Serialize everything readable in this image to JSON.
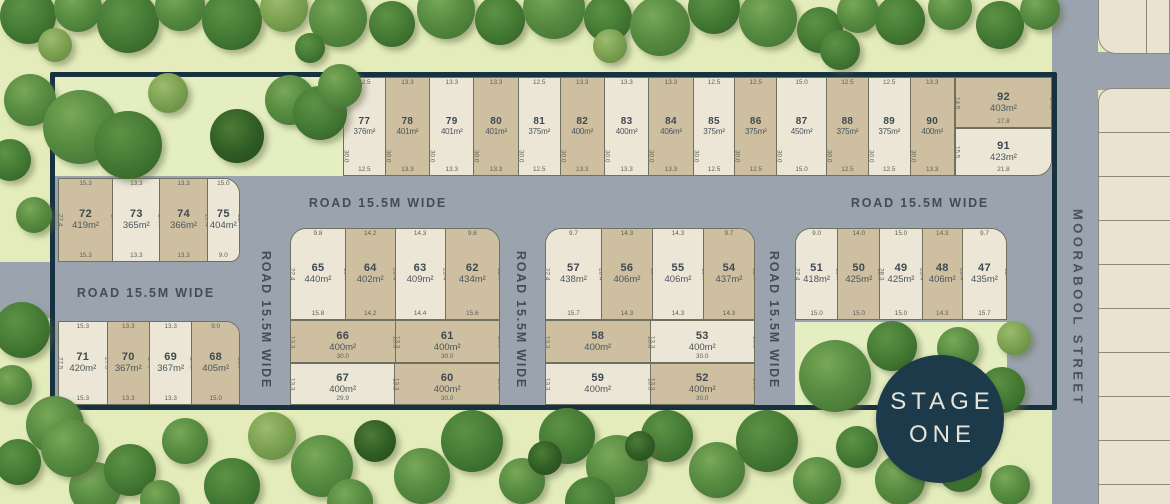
{
  "road_label": "ROAD 15.5M WIDE",
  "street_name": "MOORABOOL STREET",
  "stage_badge": {
    "line1": "STAGE",
    "line2": "ONE"
  },
  "clusters": {
    "top_row": [
      {
        "num": "77",
        "area": "376m²",
        "shade": "cream",
        "dims": {
          "top": "12.5",
          "bottom": "12.5",
          "side": "30.0"
        }
      },
      {
        "num": "78",
        "area": "401m²",
        "shade": "tan",
        "dims": {
          "top": "13.3",
          "bottom": "13.3",
          "side": "30.0"
        }
      },
      {
        "num": "79",
        "area": "401m²",
        "shade": "cream",
        "dims": {
          "top": "13.3",
          "bottom": "13.3",
          "side": "30.0"
        }
      },
      {
        "num": "80",
        "area": "401m²",
        "shade": "tan",
        "dims": {
          "top": "13.3",
          "bottom": "13.3",
          "side": "30.0"
        }
      },
      {
        "num": "81",
        "area": "375m²",
        "shade": "cream",
        "dims": {
          "top": "12.5",
          "bottom": "12.5",
          "side": "30.0"
        }
      },
      {
        "num": "82",
        "area": "400m²",
        "shade": "tan",
        "dims": {
          "top": "13.3",
          "bottom": "13.3",
          "side": "30.0"
        }
      },
      {
        "num": "83",
        "area": "400m²",
        "shade": "cream",
        "dims": {
          "top": "13.3",
          "bottom": "13.3",
          "side": "30.0"
        }
      },
      {
        "num": "84",
        "area": "406m²",
        "shade": "tan",
        "dims": {
          "top": "13.3",
          "bottom": "13.3",
          "side": "30.0"
        }
      },
      {
        "num": "85",
        "area": "375m²",
        "shade": "cream",
        "dims": {
          "top": "12.5",
          "bottom": "12.5",
          "side": "30.0"
        }
      },
      {
        "num": "86",
        "area": "375m²",
        "shade": "tan",
        "dims": {
          "top": "12.5",
          "bottom": "12.5",
          "side": "30.0"
        }
      },
      {
        "num": "87",
        "area": "450m²",
        "shade": "cream",
        "dims": {
          "top": "15.0",
          "bottom": "15.0",
          "side": "30.0"
        }
      },
      {
        "num": "88",
        "area": "375m²",
        "shade": "tan",
        "dims": {
          "top": "12.5",
          "bottom": "12.5",
          "side": "30.0"
        }
      },
      {
        "num": "89",
        "area": "375m²",
        "shade": "cream",
        "dims": {
          "top": "12.5",
          "bottom": "12.5",
          "side": "30.0"
        }
      },
      {
        "num": "90",
        "area": "400m²",
        "shade": "tan",
        "dims": {
          "top": "13.3",
          "bottom": "13.3",
          "side": "30.0"
        }
      }
    ],
    "block_92": [
      {
        "num": "92",
        "area": "403m²",
        "shade": "tan",
        "dims": {
          "left": "14.5",
          "right": "14.5",
          "bottom": "27.8"
        }
      }
    ],
    "block_91": [
      {
        "num": "91",
        "area": "423m²",
        "shade": "cream",
        "dims": {
          "left": "15.5",
          "right": "9.5",
          "bottom": "21.8"
        }
      }
    ],
    "west_a": [
      {
        "num": "72",
        "area": "419m²",
        "shade": "tan",
        "dims": {
          "top": "15.3",
          "bottom": "15.3",
          "left": "27.4",
          "right": "27.4"
        }
      },
      {
        "num": "73",
        "area": "365m²",
        "shade": "cream",
        "dims": {
          "top": "13.3",
          "bottom": "13.3",
          "right": "27.4"
        }
      },
      {
        "num": "74",
        "area": "366m²",
        "shade": "tan",
        "dims": {
          "top": "13.3",
          "bottom": "13.3",
          "right": "27.4"
        }
      },
      {
        "num": "75",
        "area": "404m²",
        "shade": "cream",
        "dims": {
          "top": "15.0",
          "bottom": "9.0",
          "right": "21.4"
        }
      }
    ],
    "west_b": [
      {
        "num": "71",
        "area": "420m²",
        "shade": "cream",
        "dims": {
          "top": "15.3",
          "bottom": "15.3",
          "left": "27.5",
          "right": "27.5"
        }
      },
      {
        "num": "70",
        "area": "367m²",
        "shade": "tan",
        "dims": {
          "top": "13.3",
          "bottom": "13.3",
          "right": "27.5"
        }
      },
      {
        "num": "69",
        "area": "367m²",
        "shade": "cream",
        "dims": {
          "top": "13.3",
          "bottom": "13.3",
          "right": "27.5"
        }
      },
      {
        "num": "68",
        "area": "405m²",
        "shade": "tan",
        "dims": {
          "top": "9.0",
          "bottom": "15.0",
          "right": "21.5"
        }
      }
    ],
    "mid_a1": [
      {
        "num": "65",
        "area": "440m²",
        "shade": "cream",
        "dims": {
          "top": "9.8",
          "bottom": "15.8",
          "left": "22.4",
          "right": "28.4"
        }
      },
      {
        "num": "64",
        "area": "402m²",
        "shade": "tan",
        "dims": {
          "top": "14.2",
          "bottom": "14.2",
          "right": "28.4"
        }
      },
      {
        "num": "63",
        "area": "409m²",
        "shade": "cream",
        "dims": {
          "top": "14.3",
          "bottom": "14.4",
          "right": "28.4"
        }
      },
      {
        "num": "62",
        "area": "434m²",
        "shade": "tan",
        "dims": {
          "top": "9.6",
          "bottom": "15.6",
          "right": "22.4"
        }
      }
    ],
    "mid_a2": [
      {
        "num": "66",
        "area": "400m²",
        "shade": "tan",
        "dims": {
          "left": "13.3",
          "right": "13.3",
          "bottom": "30.0"
        }
      },
      {
        "num": "61",
        "area": "400m²",
        "shade": "tan",
        "dims": {
          "left": "13.3",
          "right": "13.3",
          "bottom": "30.0"
        }
      }
    ],
    "mid_a3": [
      {
        "num": "67",
        "area": "400m²",
        "shade": "cream",
        "dims": {
          "left": "13.3",
          "right": "13.3",
          "bottom": "29.9"
        }
      },
      {
        "num": "60",
        "area": "400m²",
        "shade": "tan",
        "dims": {
          "left": "13.3",
          "right": "13.3",
          "bottom": "30.0"
        }
      }
    ],
    "mid_b1": [
      {
        "num": "57",
        "area": "438m²",
        "shade": "cream",
        "dims": {
          "top": "9.7",
          "bottom": "15.7",
          "left": "22.4",
          "right": "28.4"
        }
      },
      {
        "num": "56",
        "area": "406m²",
        "shade": "tan",
        "dims": {
          "top": "14.3",
          "bottom": "14.3",
          "right": "28.4"
        }
      },
      {
        "num": "55",
        "area": "406m²",
        "shade": "cream",
        "dims": {
          "top": "14.3",
          "bottom": "14.3",
          "right": "28.4"
        }
      },
      {
        "num": "54",
        "area": "437m²",
        "shade": "tan",
        "dims": {
          "top": "9.7",
          "bottom": "14.3",
          "right": "22.4"
        }
      }
    ],
    "mid_b2": [
      {
        "num": "58",
        "area": "400m²",
        "shade": "tan",
        "dims": {
          "left": "13.3",
          "right": "13.3"
        }
      },
      {
        "num": "53",
        "area": "400m²",
        "shade": "cream",
        "dims": {
          "left": "13.3",
          "right": "13.3",
          "bottom": "30.0"
        }
      }
    ],
    "mid_b3": [
      {
        "num": "59",
        "area": "400m²",
        "shade": "cream",
        "dims": {
          "left": "13.3",
          "right": "13.3"
        }
      },
      {
        "num": "52",
        "area": "400m²",
        "shade": "tan",
        "dims": {
          "left": "13.3",
          "right": "13.3",
          "bottom": "30.0"
        }
      }
    ],
    "east_c": [
      {
        "num": "51",
        "area": "418m²",
        "shade": "cream",
        "dims": {
          "top": "9.0",
          "bottom": "15.0",
          "left": "22.4",
          "right": "28.4"
        }
      },
      {
        "num": "50",
        "area": "425m²",
        "shade": "tan",
        "dims": {
          "top": "14.0",
          "bottom": "15.0",
          "right": "28.4"
        }
      },
      {
        "num": "49",
        "area": "425m²",
        "shade": "cream",
        "dims": {
          "top": "15.0",
          "bottom": "15.0",
          "left": "28.3",
          "right": "28.4"
        }
      },
      {
        "num": "48",
        "area": "406m²",
        "shade": "tan",
        "dims": {
          "top": "14.3",
          "bottom": "14.3",
          "right": "28.4"
        }
      },
      {
        "num": "47",
        "area": "435m²",
        "shade": "cream",
        "dims": {
          "top": "9.7",
          "bottom": "15.7",
          "right": "22.4"
        }
      }
    ]
  }
}
